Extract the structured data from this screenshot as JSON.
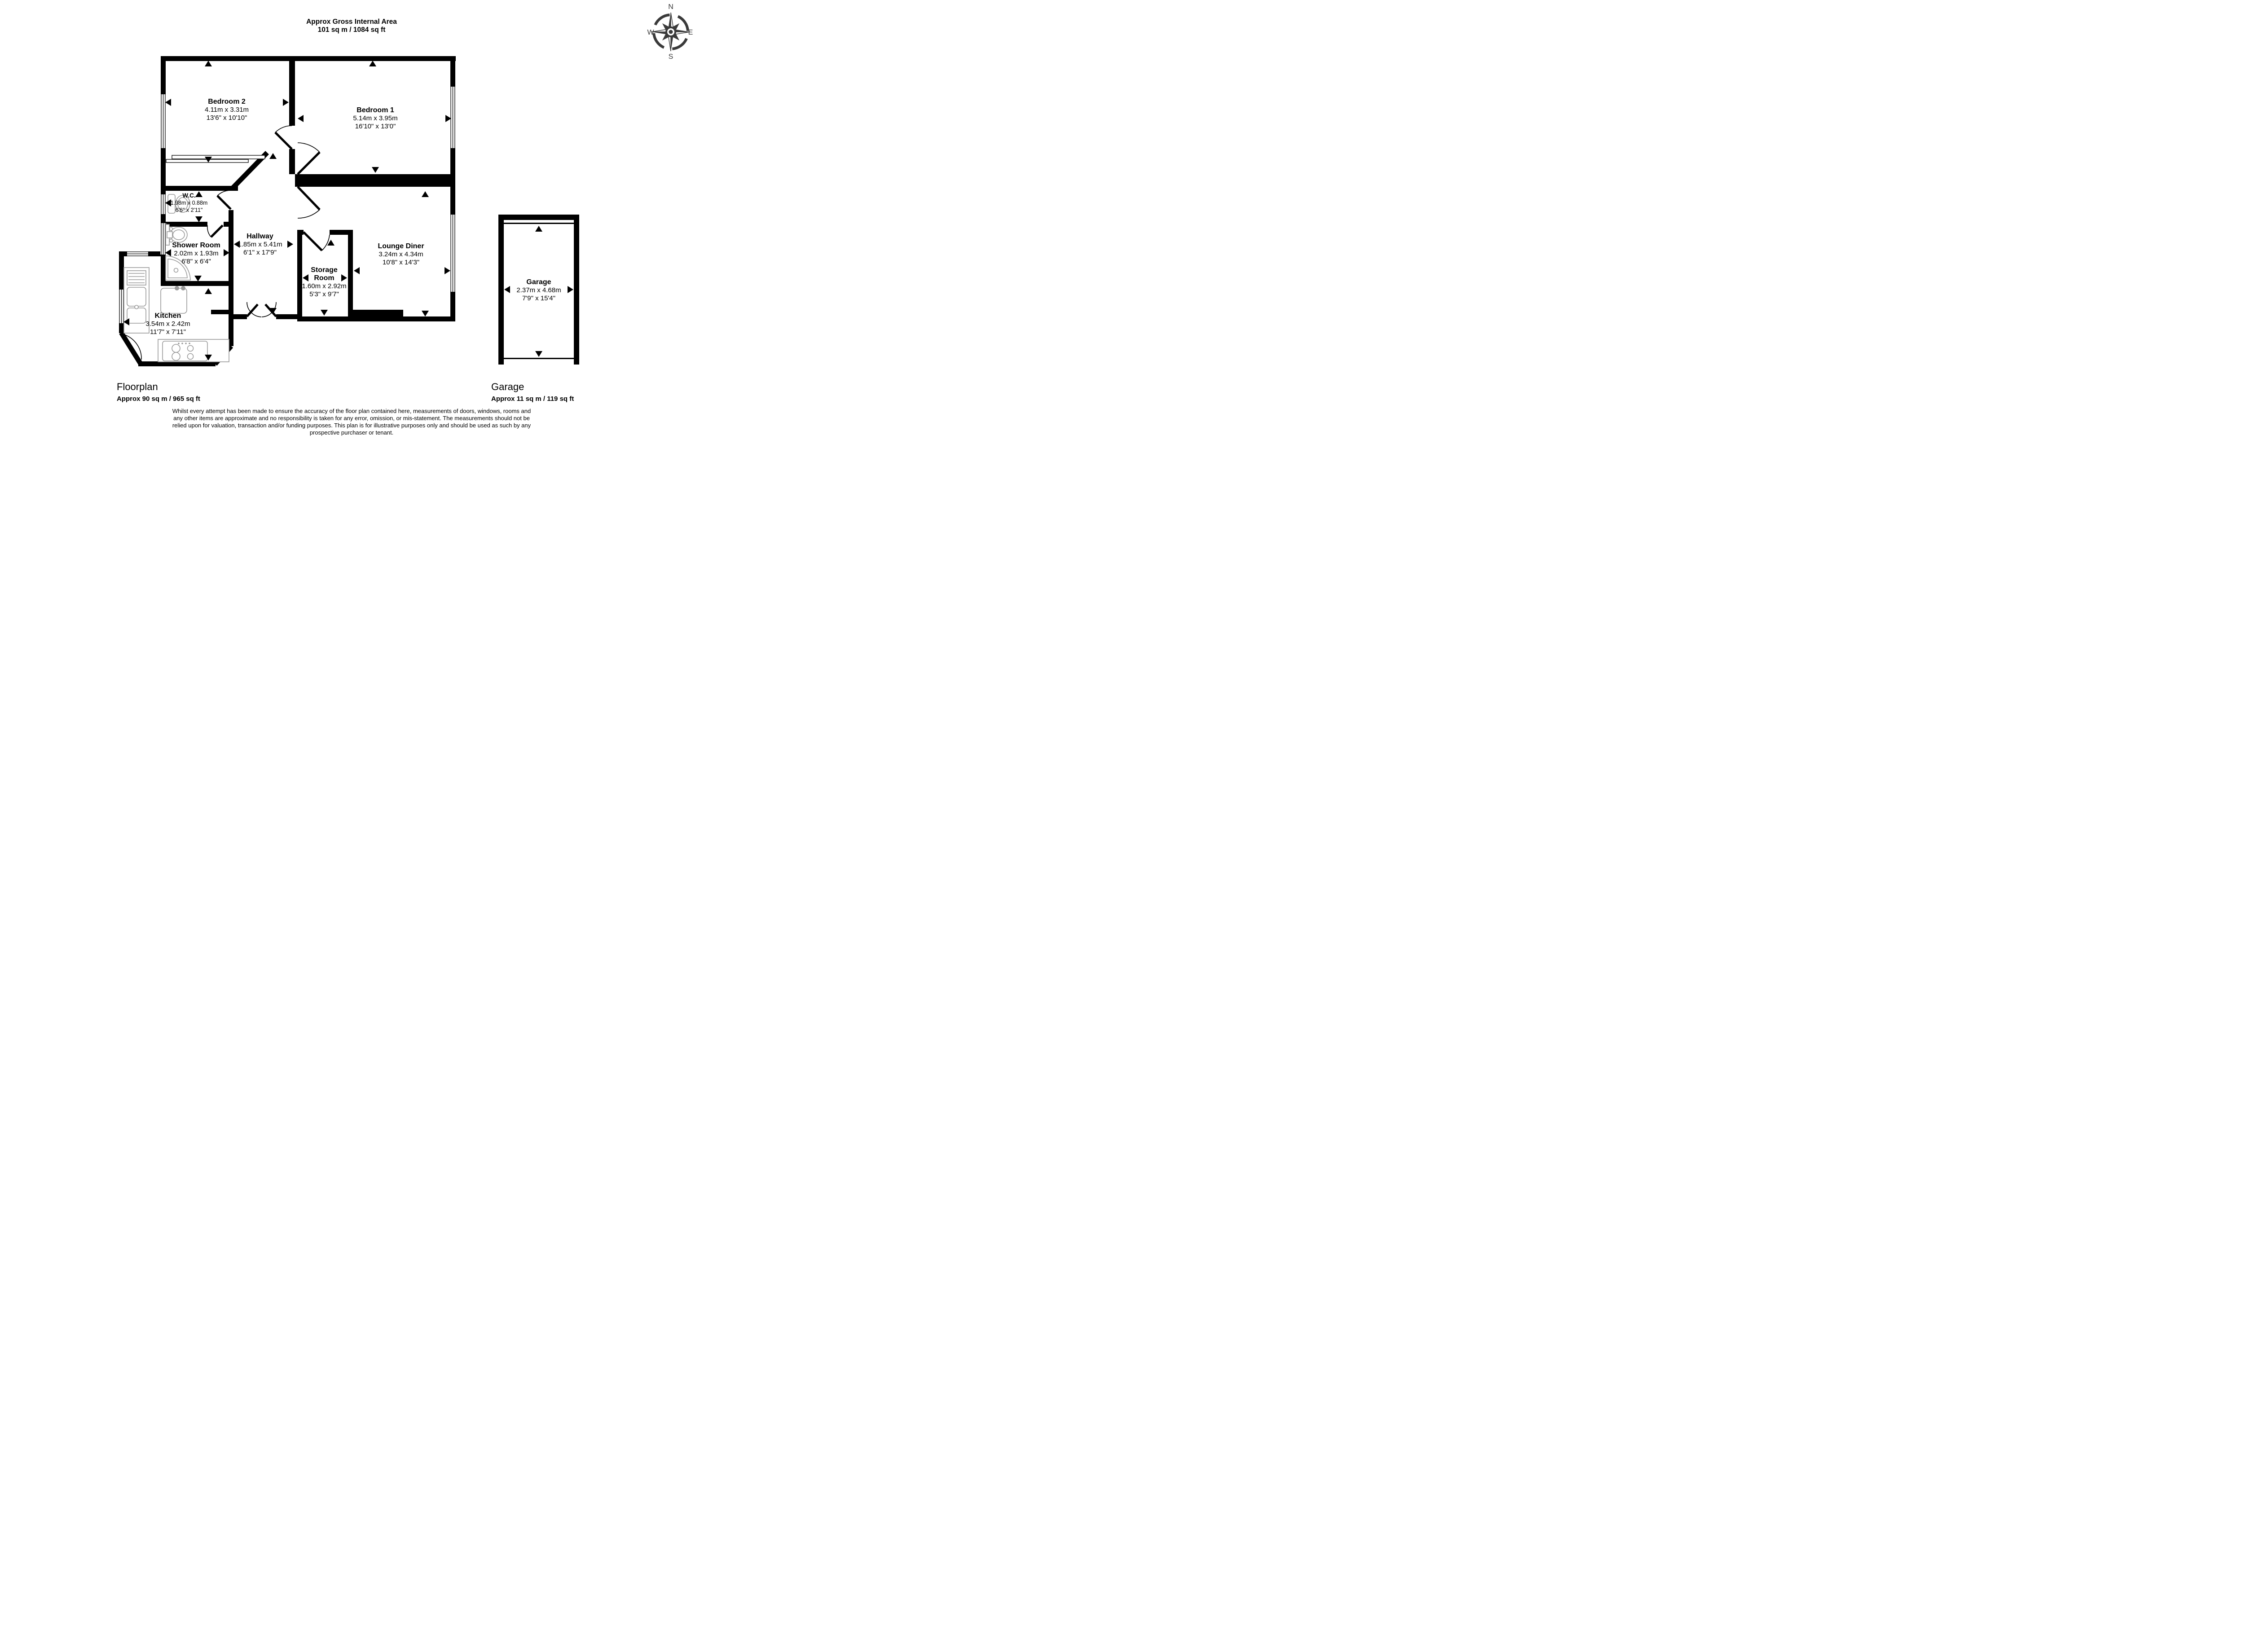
{
  "header": {
    "title_line1": "Approx Gross Internal Area",
    "title_line2": "101 sq m / 1084 sq ft"
  },
  "compass": {
    "north": "N",
    "east": "E",
    "south": "S",
    "west": "W"
  },
  "rooms": [
    {
      "id": "bedroom2",
      "name": "Bedroom 2",
      "metric": "4.11m x 3.31m",
      "imperial": "13'6\" x 10'10\""
    },
    {
      "id": "bedroom1",
      "name": "Bedroom 1",
      "metric": "5.14m x 3.95m",
      "imperial": "16'10\" x 13'0\""
    },
    {
      "id": "wc",
      "name": "W.C.",
      "metric": "1.98m x 0.88m",
      "imperial": "6'6\" x 2'11\""
    },
    {
      "id": "shower-room",
      "name": "Shower Room",
      "metric": "2.02m x 1.93m",
      "imperial": "6'8\" x 6'4\""
    },
    {
      "id": "hallway",
      "name": "Hallway",
      "metric": "1.85m x 5.41m",
      "imperial": "6'1\" x 17'9\""
    },
    {
      "id": "storage-room",
      "name_line1": "Storage",
      "name_line2": "Room",
      "metric": "1.60m x 2.92m",
      "imperial": "5'3\" x 9'7\""
    },
    {
      "id": "lounge-diner",
      "name": "Lounge Diner",
      "metric": "3.24m x 4.34m",
      "imperial": "10'8\" x 14'3\""
    },
    {
      "id": "kitchen",
      "name": "Kitchen",
      "metric": "3.54m x 2.42m",
      "imperial": "11'7\" x 7'11\""
    },
    {
      "id": "garage",
      "name": "Garage",
      "metric": "2.37m x 4.68m",
      "imperial": "7'9\" x 15'4\""
    }
  ],
  "footer": {
    "floorplan_label": "Floorplan",
    "floorplan_area": "Approx 90 sq m / 965 sq ft",
    "garage_label": "Garage",
    "garage_area": "Approx 11 sq m / 119 sq ft"
  },
  "disclaimer": {
    "line1": "Whilst every attempt has been made to ensure the accuracy of the floor plan contained here, measurements of doors, windows, rooms and",
    "line2": "any other items are approximate and no responsibility is taken for any error, omission, or mis-statement. The measurements should not be",
    "line3": "relied upon for valuation, transaction and/or funding purposes. This plan is for illustrative purposes only and should be used as such by any",
    "line4": "prospective purchaser or tenant."
  },
  "colors": {
    "wall": "#000000",
    "fixture": "#9a9a9a",
    "compass": "#3a3a3a",
    "background": "#ffffff"
  }
}
